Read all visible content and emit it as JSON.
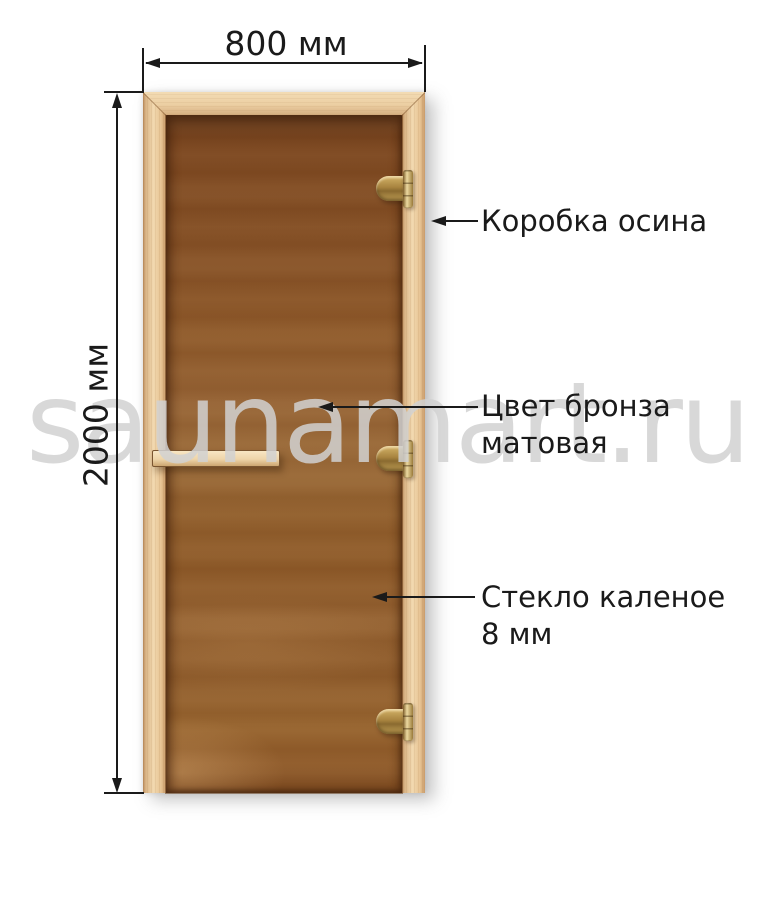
{
  "watermark": {
    "text": "saunamart.ru",
    "color": "#d1d1d1"
  },
  "dimensions": {
    "width": {
      "label": "800 мм"
    },
    "height": {
      "label": "2000 мм"
    }
  },
  "callouts": {
    "frame": {
      "line1": "Коробка осина"
    },
    "glass_color": {
      "line1": "Цвет бронза",
      "line2": "матовая"
    },
    "glass_type": {
      "line1": "Стекло каленое",
      "line2": "8 мм"
    }
  },
  "door": {
    "hinge_count": 3,
    "colors": {
      "frame_wood": "#ecd2ab",
      "glass_top": "#7c4720",
      "glass_mid": "#9a6a38",
      "hinge_brass": "#b3914f",
      "handle_wood": "#f0d8b0",
      "line_color": "#1a1a1a"
    }
  }
}
